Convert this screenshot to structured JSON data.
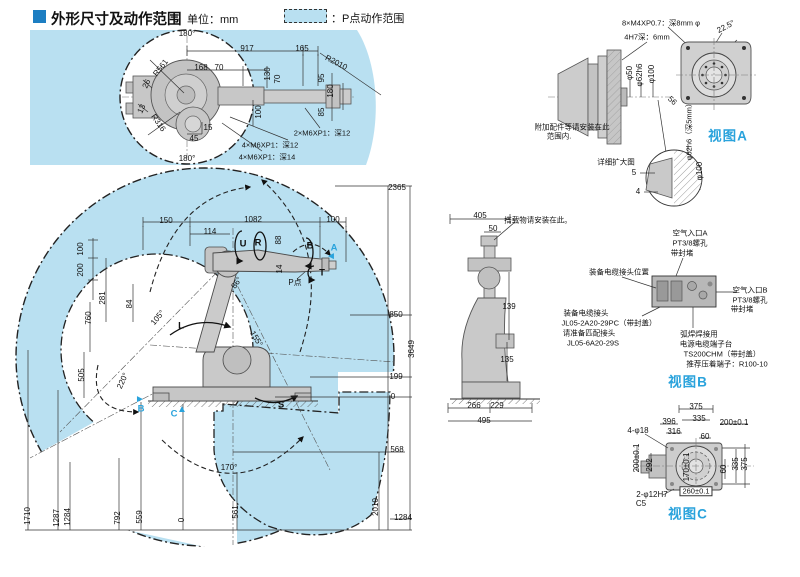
{
  "header": {
    "title": "外形尺寸及动作范围",
    "unit": "单位：mm",
    "legend_label": "：P点动作范围"
  },
  "colors": {
    "range_fill": "#b9e0f1",
    "accent_blue": "#2aa3dc",
    "header_square": "#1d7ec2",
    "line": "#333333"
  },
  "annotations": {
    "top_view": [
      {
        "t": "180°",
        "x": 187,
        "y": 34
      },
      {
        "t": "917",
        "x": 247,
        "y": 49
      },
      {
        "t": "165",
        "x": 302,
        "y": 49
      },
      {
        "t": "R2010",
        "x": 336,
        "y": 63,
        "r": 27
      },
      {
        "t": "R561",
        "x": 161,
        "y": 68,
        "r": -52
      },
      {
        "t": "168",
        "x": 201,
        "y": 68
      },
      {
        "t": "70",
        "x": 219,
        "y": 68
      },
      {
        "t": "130",
        "x": 268,
        "y": 74,
        "r": -90
      },
      {
        "t": "70",
        "x": 278,
        "y": 79,
        "r": -90
      },
      {
        "t": "95",
        "x": 322,
        "y": 78,
        "r": -90
      },
      {
        "t": "180",
        "x": 331,
        "y": 91,
        "r": -90
      },
      {
        "t": "85",
        "x": 322,
        "y": 112,
        "r": -90
      },
      {
        "t": "100",
        "x": 259,
        "y": 112,
        "r": -90
      },
      {
        "t": "26",
        "x": 147,
        "y": 84,
        "r": -65
      },
      {
        "t": "13",
        "x": 142,
        "y": 109,
        "r": -65
      },
      {
        "t": "R316",
        "x": 158,
        "y": 123,
        "r": 55
      },
      {
        "t": "15",
        "x": 208,
        "y": 128
      },
      {
        "t": "45",
        "x": 194,
        "y": 139
      },
      {
        "t": "2×M6XP1：深12",
        "x": 322,
        "y": 133,
        "k": "n"
      },
      {
        "t": "4×M6XP1：深12",
        "x": 270,
        "y": 145,
        "k": "n"
      },
      {
        "t": "4×M6XP1：深14",
        "x": 267,
        "y": 157,
        "k": "n"
      },
      {
        "t": "180°",
        "x": 187,
        "y": 159
      }
    ],
    "main_view": [
      {
        "t": "2365",
        "x": 397,
        "y": 188
      },
      {
        "t": "150",
        "x": 166,
        "y": 221
      },
      {
        "t": "1082",
        "x": 253,
        "y": 220
      },
      {
        "t": "100",
        "x": 333,
        "y": 220
      },
      {
        "t": "114",
        "x": 210,
        "y": 232
      },
      {
        "t": "U",
        "x": 243,
        "y": 244,
        "k": "j"
      },
      {
        "t": "R",
        "x": 258,
        "y": 243,
        "k": "j"
      },
      {
        "t": "88",
        "x": 279,
        "y": 240,
        "r": -90
      },
      {
        "t": "14",
        "x": 280,
        "y": 269,
        "r": -90
      },
      {
        "t": "B",
        "x": 310,
        "y": 246,
        "k": "j"
      },
      {
        "t": "A",
        "x": 334,
        "y": 248,
        "k": "b"
      },
      {
        "t": "◄",
        "x": 331,
        "y": 257,
        "k": "ba"
      },
      {
        "t": "T",
        "x": 322,
        "y": 273,
        "k": "j"
      },
      {
        "t": "P点",
        "x": 295,
        "y": 283
      },
      {
        "t": "86°",
        "x": 237,
        "y": 283,
        "r": -55
      },
      {
        "t": "100",
        "x": 81,
        "y": 249,
        "r": -90
      },
      {
        "t": "200",
        "x": 81,
        "y": 270,
        "r": -90
      },
      {
        "t": "281",
        "x": 103,
        "y": 298,
        "r": -90
      },
      {
        "t": "84",
        "x": 130,
        "y": 304,
        "r": -90
      },
      {
        "t": "105°",
        "x": 158,
        "y": 318,
        "r": -50
      },
      {
        "t": "L",
        "x": 181,
        "y": 326,
        "k": "j"
      },
      {
        "t": "155°",
        "x": 256,
        "y": 339,
        "r": 58
      },
      {
        "t": "760",
        "x": 89,
        "y": 318,
        "r": -90
      },
      {
        "t": "505",
        "x": 82,
        "y": 375,
        "r": -90
      },
      {
        "t": "220°",
        "x": 123,
        "y": 381,
        "r": -65
      },
      {
        "t": "►",
        "x": 140,
        "y": 400,
        "k": "ba"
      },
      {
        "t": "B",
        "x": 141,
        "y": 409,
        "k": "b"
      },
      {
        "t": "▲",
        "x": 182,
        "y": 410,
        "k": "ba"
      },
      {
        "t": "C",
        "x": 174,
        "y": 414,
        "k": "b"
      },
      {
        "t": "S",
        "x": 281,
        "y": 405,
        "k": "j"
      },
      {
        "t": "850",
        "x": 396,
        "y": 315
      },
      {
        "t": "3649",
        "x": 412,
        "y": 349,
        "r": -90
      },
      {
        "t": "199",
        "x": 396,
        "y": 377
      },
      {
        "t": "0",
        "x": 393,
        "y": 397
      },
      {
        "t": "568",
        "x": 397,
        "y": 450
      },
      {
        "t": "2010",
        "x": 376,
        "y": 507,
        "r": -90
      },
      {
        "t": "1284",
        "x": 403,
        "y": 518
      },
      {
        "t": "170°",
        "x": 229,
        "y": 468
      },
      {
        "t": "561",
        "x": 236,
        "y": 512,
        "r": -90
      },
      {
        "t": "0",
        "x": 182,
        "y": 520,
        "r": -90
      },
      {
        "t": "559",
        "x": 140,
        "y": 517,
        "r": -90
      },
      {
        "t": "792",
        "x": 118,
        "y": 518,
        "r": -90
      },
      {
        "t": "1284",
        "x": 68,
        "y": 517,
        "r": -90
      },
      {
        "t": "1287",
        "x": 57,
        "y": 518,
        "r": -90
      },
      {
        "t": "1710",
        "x": 28,
        "y": 516,
        "r": -90
      }
    ],
    "view_a": [
      {
        "t": "8×M4XP0.7：深8mm φ",
        "x": 661,
        "y": 23,
        "k": "n"
      },
      {
        "t": "4H7深：6mm",
        "x": 647,
        "y": 37,
        "k": "n"
      },
      {
        "t": "22.5°",
        "x": 726,
        "y": 27,
        "r": -28
      },
      {
        "t": "φ50",
        "x": 630,
        "y": 73,
        "r": -90
      },
      {
        "t": "φ62h6",
        "x": 640,
        "y": 75,
        "r": -90
      },
      {
        "t": "φ100",
        "x": 652,
        "y": 74,
        "r": -90
      },
      {
        "t": "56",
        "x": 672,
        "y": 101,
        "r": 42
      },
      {
        "t": "附加配件等请安装在此",
        "x": 572,
        "y": 127,
        "k": "n"
      },
      {
        "t": "范围内.",
        "x": 559,
        "y": 136,
        "k": "n"
      },
      {
        "t": "详细扩大图",
        "x": 616,
        "y": 162,
        "k": "n"
      },
      {
        "t": "5",
        "x": 634,
        "y": 173
      },
      {
        "t": "4",
        "x": 638,
        "y": 192
      },
      {
        "t": "φ62h6（深5mm）",
        "x": 689,
        "y": 130,
        "r": -90,
        "k": "n"
      },
      {
        "t": "φ100",
        "x": 700,
        "y": 171,
        "r": -90
      },
      {
        "t": "视图A",
        "x": 728,
        "y": 136,
        "k": "v"
      }
    ],
    "view_b": [
      {
        "t": "405",
        "x": 480,
        "y": 216
      },
      {
        "t": "50",
        "x": 493,
        "y": 229
      },
      {
        "t": "搭载物请安装在此。",
        "x": 538,
        "y": 220,
        "k": "n"
      },
      {
        "t": "装备电缆接头位置",
        "x": 619,
        "y": 272,
        "k": "n"
      },
      {
        "t": "139",
        "x": 509,
        "y": 307
      },
      {
        "t": "135",
        "x": 507,
        "y": 360
      },
      {
        "t": "266",
        "x": 474,
        "y": 406
      },
      {
        "t": "229",
        "x": 497,
        "y": 406
      },
      {
        "t": "495",
        "x": 484,
        "y": 421
      },
      {
        "t": "空气入口A",
        "x": 690,
        "y": 233,
        "k": "n"
      },
      {
        "t": "PT3/8螺孔",
        "x": 690,
        "y": 243,
        "k": "n"
      },
      {
        "t": "带封堵",
        "x": 682,
        "y": 253,
        "k": "n"
      },
      {
        "t": "空气入口B",
        "x": 750,
        "y": 290,
        "k": "n"
      },
      {
        "t": "PT3/8螺孔",
        "x": 750,
        "y": 300,
        "k": "n"
      },
      {
        "t": "带封堵",
        "x": 742,
        "y": 309,
        "k": "n"
      },
      {
        "t": "装备电缆接头",
        "x": 586,
        "y": 313,
        "k": "n"
      },
      {
        "t": "JL05-2A20-29PC（带封盖）",
        "x": 609,
        "y": 323,
        "k": "n"
      },
      {
        "t": "请准备匹配接头",
        "x": 589,
        "y": 333,
        "k": "n"
      },
      {
        "t": "JL05-6A20-29S",
        "x": 593,
        "y": 343,
        "k": "n"
      },
      {
        "t": "弧焊焊接用",
        "x": 699,
        "y": 334,
        "k": "n"
      },
      {
        "t": "电源电缆端子台",
        "x": 706,
        "y": 344,
        "k": "n"
      },
      {
        "t": "TS200CHM（带封盖）",
        "x": 722,
        "y": 354,
        "k": "n"
      },
      {
        "t": "推荐压着端子：R100-10",
        "x": 727,
        "y": 364,
        "k": "n"
      },
      {
        "t": "视图B",
        "x": 688,
        "y": 382,
        "k": "v"
      }
    ],
    "view_c": [
      {
        "t": "375",
        "x": 696,
        "y": 407
      },
      {
        "t": "335",
        "x": 699,
        "y": 419
      },
      {
        "t": "396",
        "x": 669,
        "y": 422
      },
      {
        "t": "200±0.1",
        "x": 734,
        "y": 423
      },
      {
        "t": "316",
        "x": 674,
        "y": 432
      },
      {
        "t": "60",
        "x": 705,
        "y": 437
      },
      {
        "t": "4-φ18",
        "x": 638,
        "y": 431
      },
      {
        "t": "200±0.1",
        "x": 637,
        "y": 458,
        "r": -90
      },
      {
        "t": "292",
        "x": 650,
        "y": 465,
        "r": -90
      },
      {
        "t": "170±0.1",
        "x": 687,
        "y": 467,
        "r": -90
      },
      {
        "t": "60",
        "x": 724,
        "y": 469,
        "r": -90
      },
      {
        "t": "335",
        "x": 736,
        "y": 464,
        "r": -90
      },
      {
        "t": "375",
        "x": 745,
        "y": 464,
        "r": -90
      },
      {
        "t": "260±0.1",
        "x": 696,
        "y": 491,
        "k": "x"
      },
      {
        "t": "2-φ12H7",
        "x": 652,
        "y": 495
      },
      {
        "t": "C5",
        "x": 641,
        "y": 504
      },
      {
        "t": "视图C",
        "x": 688,
        "y": 514,
        "k": "v"
      }
    ]
  }
}
